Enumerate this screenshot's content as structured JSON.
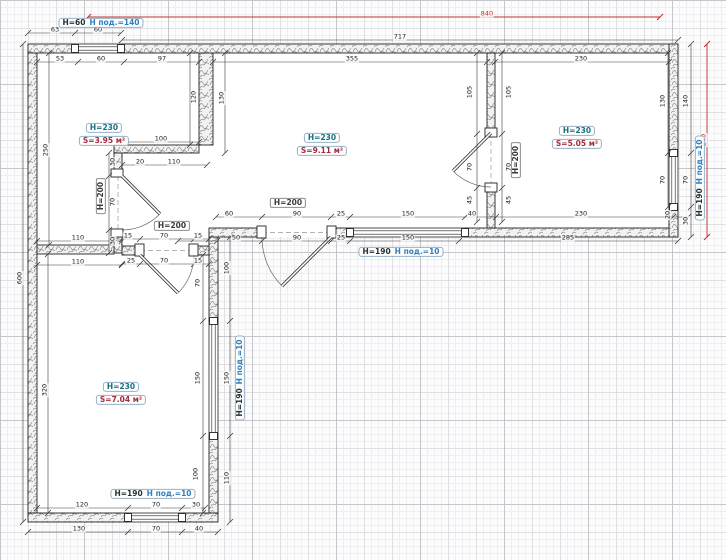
{
  "drawing": {
    "type": "floor-plan",
    "units": "cm",
    "colors": {
      "overall_dim": "#c22a2a",
      "dim": "#1c1c1c",
      "room_height_label": "#17707f",
      "room_area_label": "#a02c3c",
      "window_pod_label": "#2f7fbe"
    }
  },
  "labels": [
    {
      "type": "dim",
      "text": "840",
      "x": 487,
      "y": 14,
      "red": true
    },
    {
      "type": "dim",
      "text": "240",
      "x": 704,
      "y": 140,
      "rot": true,
      "red": true
    },
    {
      "type": "dim",
      "text": "717",
      "x": 400,
      "y": 37
    },
    {
      "type": "dim",
      "text": "63",
      "x": 55,
      "y": 30
    },
    {
      "type": "dim",
      "text": "60",
      "x": 98,
      "y": 30
    },
    {
      "type": "dim",
      "text": "53",
      "x": 60,
      "y": 59
    },
    {
      "type": "dim",
      "text": "60",
      "x": 101,
      "y": 59
    },
    {
      "type": "dim",
      "text": "97",
      "x": 162,
      "y": 59
    },
    {
      "type": "dim",
      "text": "355",
      "x": 352,
      "y": 59
    },
    {
      "type": "dim",
      "text": "230",
      "x": 581,
      "y": 59
    },
    {
      "type": "dim",
      "text": "100",
      "x": 161,
      "y": 139
    },
    {
      "type": "dim",
      "text": "20",
      "x": 140,
      "y": 162
    },
    {
      "type": "dim",
      "text": "110",
      "x": 174,
      "y": 162
    },
    {
      "type": "dim",
      "text": "120",
      "x": 194,
      "y": 97,
      "rot": true
    },
    {
      "type": "dim",
      "text": "130",
      "x": 222,
      "y": 98,
      "rot": true
    },
    {
      "type": "dim",
      "text": "250",
      "x": 46,
      "y": 150,
      "rot": true
    },
    {
      "type": "dim",
      "text": "600",
      "x": 20,
      "y": 278,
      "rot": true
    },
    {
      "type": "dim",
      "text": "320",
      "x": 45,
      "y": 390,
      "rot": true
    },
    {
      "type": "dim",
      "text": "30",
      "x": 113,
      "y": 162,
      "rot": true
    },
    {
      "type": "dim",
      "text": "70",
      "x": 113,
      "y": 202,
      "rot": true
    },
    {
      "type": "dim",
      "text": "30",
      "x": 113,
      "y": 241,
      "rot": true
    },
    {
      "type": "dim",
      "text": "110",
      "x": 78,
      "y": 238
    },
    {
      "type": "dim",
      "text": "110",
      "x": 78,
      "y": 262
    },
    {
      "type": "dim",
      "text": "15",
      "x": 128,
      "y": 236
    },
    {
      "type": "dim",
      "text": "70",
      "x": 164,
      "y": 236
    },
    {
      "type": "dim",
      "text": "15",
      "x": 198,
      "y": 236
    },
    {
      "type": "dim",
      "text": "25",
      "x": 131,
      "y": 261
    },
    {
      "type": "dim",
      "text": "70",
      "x": 164,
      "y": 261
    },
    {
      "type": "dim",
      "text": "15",
      "x": 198,
      "y": 261
    },
    {
      "type": "dim",
      "text": "70",
      "x": 198,
      "y": 283,
      "rot": true
    },
    {
      "type": "dim",
      "text": "100",
      "x": 227,
      "y": 268,
      "rot": true
    },
    {
      "type": "dim",
      "text": "150",
      "x": 198,
      "y": 378,
      "rot": true
    },
    {
      "type": "dim",
      "text": "150",
      "x": 227,
      "y": 378,
      "rot": true
    },
    {
      "type": "dim",
      "text": "100",
      "x": 196,
      "y": 474,
      "rot": true
    },
    {
      "type": "dim",
      "text": "110",
      "x": 227,
      "y": 478,
      "rot": true
    },
    {
      "type": "dim",
      "text": "120",
      "x": 82,
      "y": 505
    },
    {
      "type": "dim",
      "text": "70",
      "x": 156,
      "y": 505
    },
    {
      "type": "dim",
      "text": "30",
      "x": 196,
      "y": 505
    },
    {
      "type": "dim",
      "text": "130",
      "x": 79,
      "y": 529
    },
    {
      "type": "dim",
      "text": "70",
      "x": 156,
      "y": 529
    },
    {
      "type": "dim",
      "text": "40",
      "x": 199,
      "y": 529
    },
    {
      "type": "dim",
      "text": "60",
      "x": 229,
      "y": 214
    },
    {
      "type": "dim",
      "text": "90",
      "x": 297,
      "y": 214
    },
    {
      "type": "dim",
      "text": "25",
      "x": 341,
      "y": 214
    },
    {
      "type": "dim",
      "text": "150",
      "x": 408,
      "y": 214
    },
    {
      "type": "dim",
      "text": "40",
      "x": 472,
      "y": 214
    },
    {
      "type": "dim",
      "text": "230",
      "x": 581,
      "y": 214
    },
    {
      "type": "dim",
      "text": "20",
      "x": 668,
      "y": 215,
      "rot": true
    },
    {
      "type": "dim",
      "text": "50",
      "x": 236,
      "y": 238
    },
    {
      "type": "dim",
      "text": "90",
      "x": 297,
      "y": 238
    },
    {
      "type": "dim",
      "text": "25",
      "x": 341,
      "y": 238
    },
    {
      "type": "dim",
      "text": "150",
      "x": 408,
      "y": 238
    },
    {
      "type": "dim",
      "text": "285",
      "x": 568,
      "y": 238
    },
    {
      "type": "dim",
      "text": "105",
      "x": 470,
      "y": 92,
      "rot": true
    },
    {
      "type": "dim",
      "text": "105",
      "x": 509,
      "y": 92,
      "rot": true
    },
    {
      "type": "dim",
      "text": "70",
      "x": 470,
      "y": 167,
      "rot": true
    },
    {
      "type": "dim",
      "text": "70",
      "x": 509,
      "y": 167,
      "rot": true
    },
    {
      "type": "dim",
      "text": "45",
      "x": 470,
      "y": 200,
      "rot": true
    },
    {
      "type": "dim",
      "text": "45",
      "x": 509,
      "y": 200,
      "rot": true
    },
    {
      "type": "dim",
      "text": "130",
      "x": 663,
      "y": 101,
      "rot": true
    },
    {
      "type": "dim",
      "text": "140",
      "x": 686,
      "y": 101,
      "rot": true
    },
    {
      "type": "dim",
      "text": "70",
      "x": 663,
      "y": 180,
      "rot": true
    },
    {
      "type": "dim",
      "text": "70",
      "x": 686,
      "y": 180,
      "rot": true
    },
    {
      "type": "dim",
      "text": "30",
      "x": 686,
      "y": 221,
      "rot": true
    },
    {
      "type": "room",
      "height": "H=230",
      "area": "S=3.95 м²",
      "x": 104,
      "y": 128
    },
    {
      "type": "room",
      "height": "H=230",
      "area": "S=9.11 м²",
      "x": 322,
      "y": 138
    },
    {
      "type": "room",
      "height": "H=230",
      "area": "S=5.05 м²",
      "x": 577,
      "y": 131
    },
    {
      "type": "room",
      "height": "H=230",
      "area": "S=7.04 м²",
      "x": 121,
      "y": 387
    },
    {
      "type": "window",
      "height": "H=60",
      "pod": "Н под.=140",
      "x": 101,
      "y": 23
    },
    {
      "type": "window",
      "height": "H=190",
      "pod": "Н под.=10",
      "x": 401,
      "y": 252
    },
    {
      "type": "window",
      "height": "H=190",
      "pod": "Н под.=10",
      "x": 153,
      "y": 494
    },
    {
      "type": "window",
      "height": "H=190",
      "pod": "Н под.=10",
      "x": 240,
      "y": 378,
      "rot": true
    },
    {
      "type": "window",
      "height": "H=190",
      "pod": "Н под.=10",
      "x": 700,
      "y": 178,
      "rot": true
    },
    {
      "type": "door",
      "text": "H=200",
      "x": 288,
      "y": 203
    },
    {
      "type": "door",
      "text": "H=200",
      "x": 172,
      "y": 226
    },
    {
      "type": "door",
      "text": "H=200",
      "x": 101,
      "y": 196,
      "rot": true
    },
    {
      "type": "door",
      "text": "H=200",
      "x": 516,
      "y": 160,
      "rot": true
    }
  ]
}
